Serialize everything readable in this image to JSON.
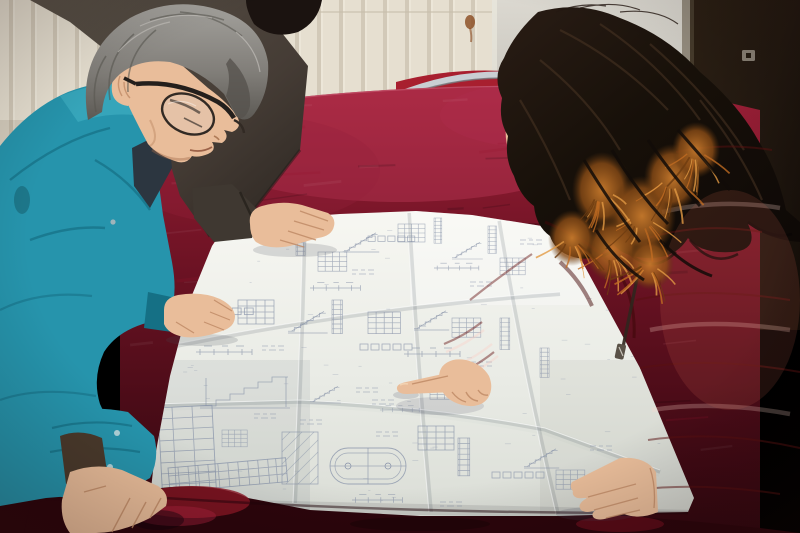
{
  "scene": {
    "title": "Two workers reviewing a large folded construction blueprint spread on a red velvet table"
  },
  "palette": {
    "wall": "#e6dfd0",
    "groove": "#bdb3a0",
    "wall_line": "#c8bfac",
    "panel_hi": "#dbd8d0",
    "panel_lo": "#aeaba3",
    "door": "#261b12",
    "door_dk": "#150e08",
    "frame": "#958d7f",
    "lock": "#8a8276",
    "velvet_hi": "#a32340",
    "velvet": "#8e1b2e",
    "velvet_mid": "#691122",
    "velvet_dark": "#470b16",
    "velvet_front": "#2c050c",
    "chair": "#a81f2f",
    "chrome": "#c9ced3",
    "chrome_dk": "#74787c",
    "paper": "#eef0ea",
    "paper_hi": "#f7f7f2",
    "paper_sh": "#d8dbd4",
    "ink": "#8691a8",
    "teal": "#2694ac",
    "teal_hi": "#46b5c8",
    "teal_dk": "#157085",
    "teal_deep": "#0e5a6e",
    "jacket": "#4a423a",
    "jacket_dk": "#2b2520",
    "hair_black": "#1b1310",
    "hair_gray": "#93918c",
    "hair_gray_dk": "#56534e",
    "hair_brown": "#3a2a20",
    "skin": "#e9bd9a",
    "skin_sh": "#c08b66",
    "skin_hi": "#f3d4b4",
    "coat": "#c33630",
    "coat_dk": "#8c1f1d",
    "coat_deep": "#691212",
    "coat_hi": "#d4544a",
    "fur": "#c06c22",
    "fur_dk": "#6e3c10",
    "fur_light": "#e29a43",
    "under_dark": "#2c3640"
  }
}
